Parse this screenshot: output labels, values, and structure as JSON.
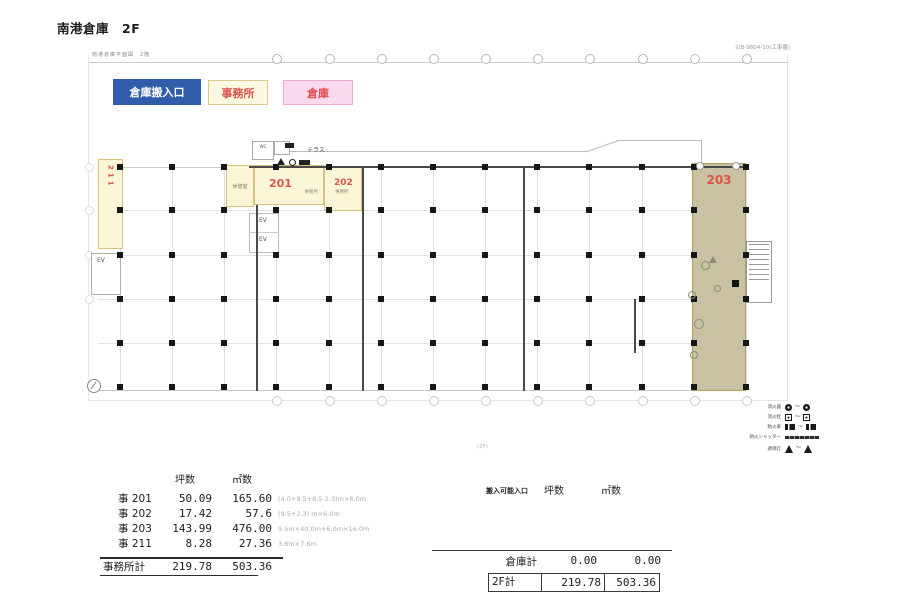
{
  "page": {
    "title": "南港倉庫　2F",
    "doc_ref": "以B-9804-10(工事番)",
    "plan_caption": "南港倉庫平面図　2階",
    "floor_note": "(2F)"
  },
  "legend_chips": [
    {
      "label": "倉庫搬入口",
      "bg": "#2f5cab",
      "fg": "#ffffff",
      "border": "#2f5cab"
    },
    {
      "label": "事務所",
      "bg": "#fdf8e1",
      "fg": "#d9534f",
      "border": "#dcc98c"
    },
    {
      "label": "倉庫",
      "bg": "#fbd9ee",
      "fg": "#e14b4b",
      "border": "#efa9d4"
    }
  ],
  "plan": {
    "terrace_label": "テラス",
    "rooms": {
      "r201": {
        "number": "201",
        "sub": "事務所"
      },
      "r202": {
        "number": "202",
        "sub": "事務所"
      },
      "r203": {
        "number": "203"
      },
      "r211": {
        "number": "211"
      }
    },
    "labels": {
      "rest_room": "休憩室",
      "ev": "EV",
      "wc": "WC"
    }
  },
  "symbol_legend": {
    "tilde": "～",
    "rows": [
      {
        "label": "消火器"
      },
      {
        "label": "消火栓"
      },
      {
        "label": "防火扉"
      },
      {
        "label": "防火シャッター"
      },
      {
        "label": "誘導灯"
      }
    ]
  },
  "office_table": {
    "col_headers": [
      "坪数",
      "㎡数"
    ],
    "rows": [
      {
        "label": "事 201",
        "tsubo": "50.09",
        "sqm": "165.60",
        "note": "(4.0+9.5+8.5-2.3)m×6.0m"
      },
      {
        "label": "事 202",
        "tsubo": "17.42",
        "sqm": "57.6",
        "note": "(9.5+2.3) m×6.0m"
      },
      {
        "label": "事 203",
        "tsubo": "143.99",
        "sqm": "476.00",
        "note": "9.5m×40.0m+6.0m×16.0m"
      },
      {
        "label": "事 211",
        "tsubo": "8.28",
        "sqm": "27.36",
        "note": "3.6m×7.6m"
      }
    ],
    "total": {
      "label": "事務所計",
      "tsubo": "219.78",
      "sqm": "503.36"
    }
  },
  "summary_table": {
    "entrance_header": "搬入可能入口",
    "col_headers": [
      "坪数",
      "㎡数"
    ],
    "warehouse_total": {
      "label": "倉庫計",
      "tsubo": "0.00",
      "sqm": "0.00"
    },
    "floor_total": {
      "label": "2F計",
      "tsubo": "219.78",
      "sqm": "503.36"
    }
  },
  "colors": {
    "office_fill": "#fcf6d9",
    "office_border": "#d6c27a",
    "warehouse_203_fill": "#c9c1a4",
    "accent_red": "#d9534f"
  }
}
